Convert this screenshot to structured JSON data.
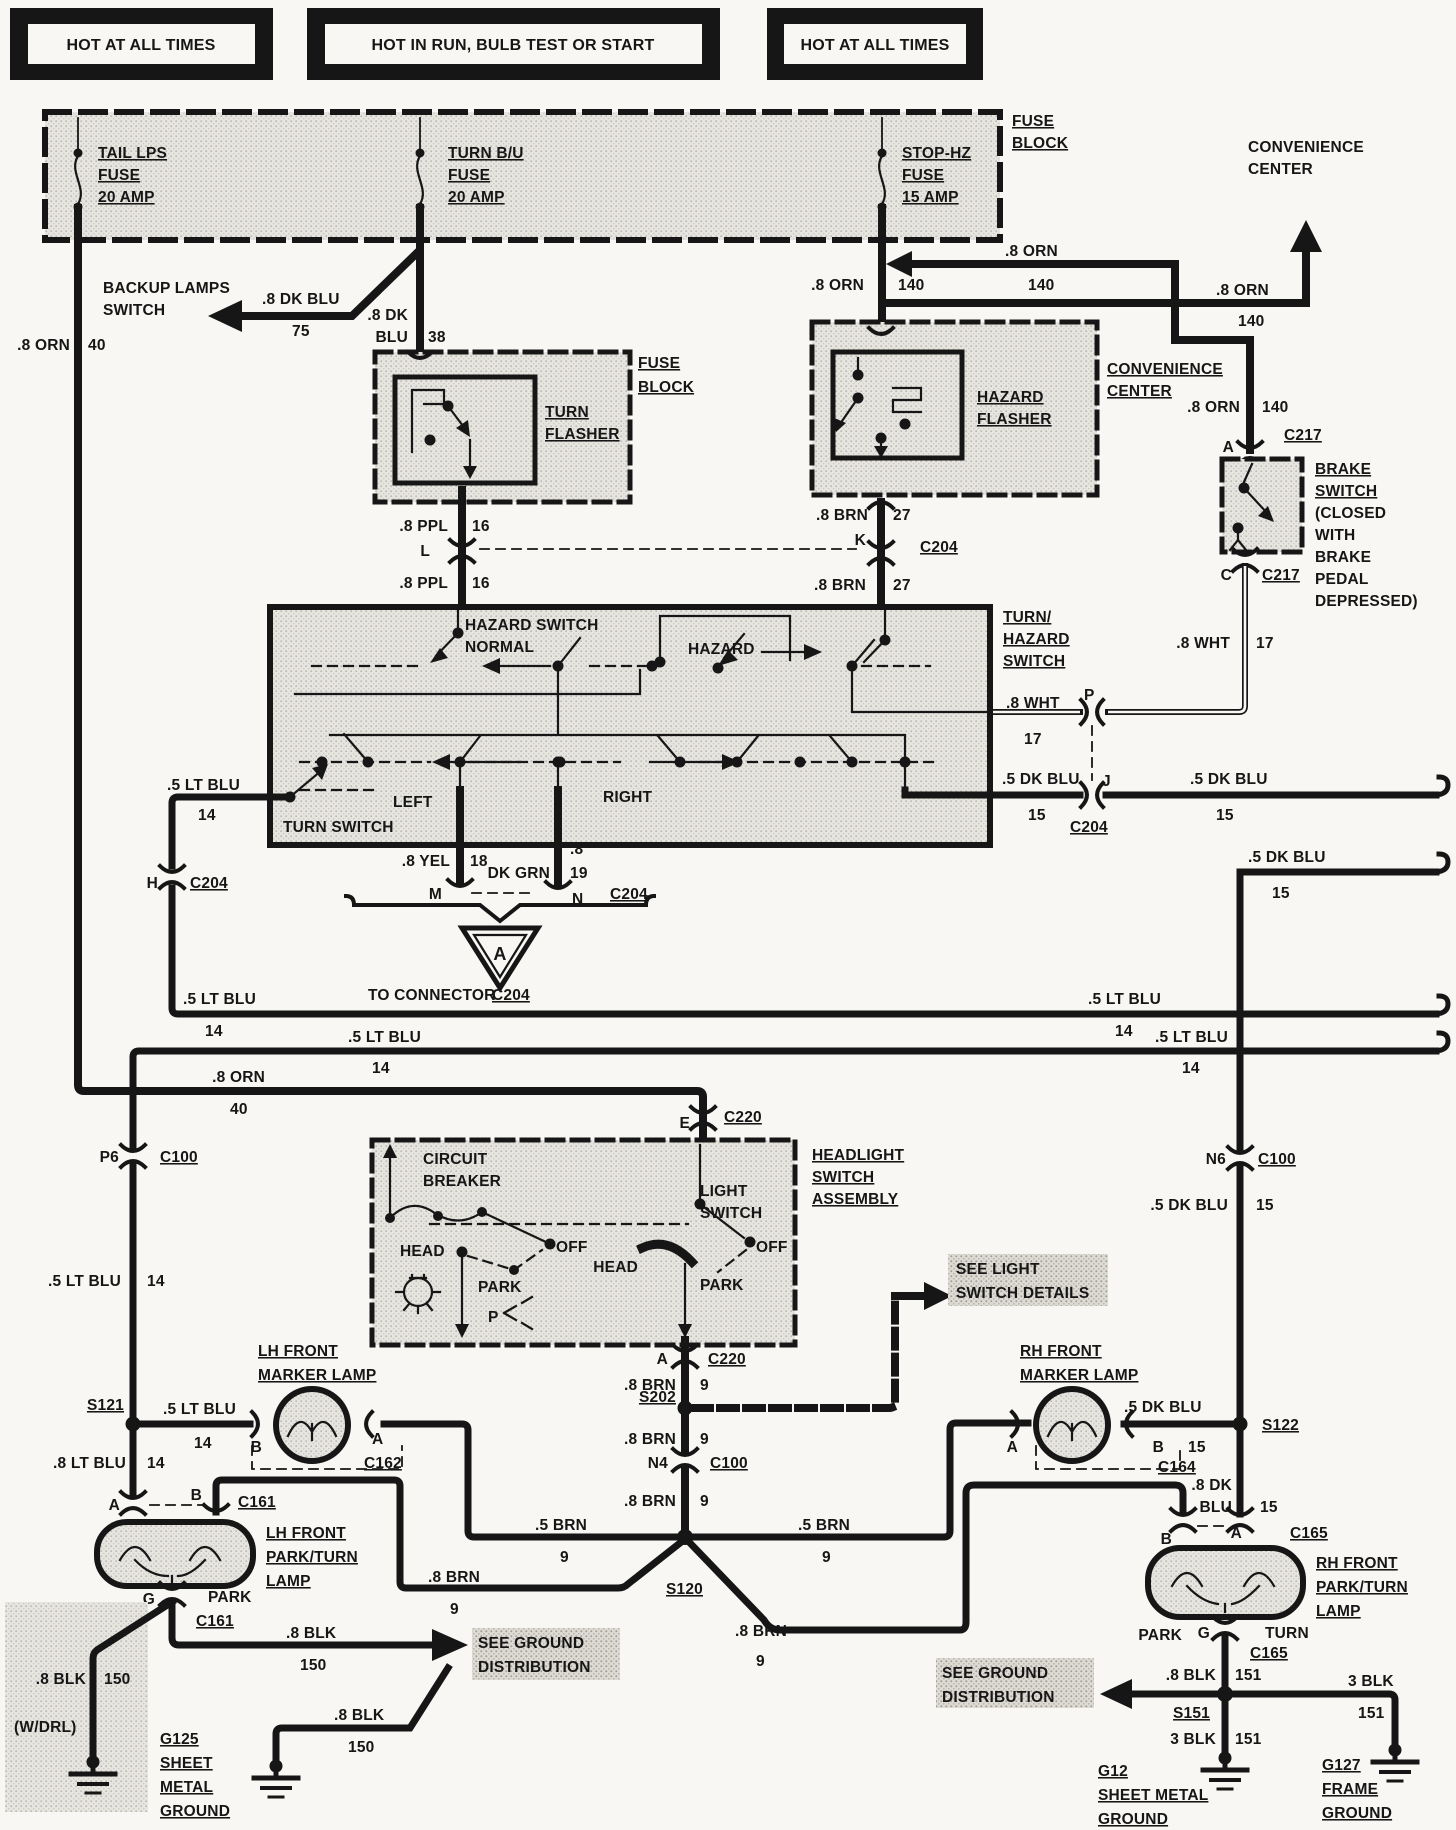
{
  "colors": {
    "ink": "#161616",
    "paper": "#f8f7f4",
    "shade": "#e7e5e0",
    "shade_dark": "#dedbd4"
  },
  "headers": {
    "h1": "HOT AT ALL TIMES",
    "h2": "HOT IN RUN, BULB TEST OR START",
    "h3": "HOT AT ALL TIMES"
  },
  "fuse_block": {
    "title": [
      "FUSE",
      "BLOCK"
    ],
    "tail": [
      "TAIL LPS",
      "FUSE",
      "20 AMP"
    ],
    "turn": [
      "TURN B/U",
      "FUSE",
      "20 AMP"
    ],
    "stop": [
      "STOP-HZ",
      "FUSE",
      "15 AMP"
    ]
  },
  "wires": {
    "orn": ".8 ORN",
    "n140": "140",
    "n40": "40",
    "dkblu8": ".8 DK BLU",
    "n75": "75",
    "dk8": ".8 DK",
    "blu": "BLU",
    "n38": "38",
    "ppl": ".8 PPL",
    "n16": "16",
    "brn8": ".8 BRN",
    "n27": "27",
    "n9": "9",
    "brn5": ".5 BRN",
    "wht": ".8 WHT",
    "n17": "17",
    "dkblu5": ".5 DK BLU",
    "n15": "15",
    "ltblu5": ".5 LT BLU",
    "ltblu8": ".8 LT BLU",
    "n14": "14",
    "yel": ".8 YEL",
    "n18": "18",
    "dot8": ".8",
    "dkgrn": "DK GRN",
    "n19": "19",
    "blk8": ".8 BLK",
    "n150": "150",
    "n151": "151",
    "blk3": "3 BLK"
  },
  "components": {
    "backup": [
      "BACKUP LAMPS",
      "SWITCH"
    ],
    "fuse_block2": [
      "FUSE",
      "BLOCK"
    ],
    "turn_flasher": [
      "TURN",
      "FLASHER"
    ],
    "hazard_flasher": [
      "HAZARD",
      "FLASHER"
    ],
    "convenience": [
      "CONVENIENCE",
      "CENTER"
    ],
    "brake_switch": [
      "BRAKE",
      "SWITCH",
      "(CLOSED",
      "WITH",
      "BRAKE",
      "PEDAL",
      "DEPRESSED)"
    ],
    "turn_hazard": [
      "TURN/",
      "HAZARD",
      "SWITCH"
    ],
    "hazard_normal": [
      "HAZARD SWITCH",
      "NORMAL"
    ],
    "hazard_pos": "HAZARD",
    "left": "LEFT",
    "right": "RIGHT",
    "turn_switch": "TURN SWITCH",
    "to_connector": "TO CONNECTOR",
    "tri_a": "A",
    "hsa": [
      "HEADLIGHT",
      "SWITCH",
      "ASSEMBLY"
    ],
    "circuit_breaker": [
      "CIRCUIT",
      "BREAKER"
    ],
    "light_switch": [
      "LIGHT",
      "SWITCH"
    ],
    "head": "HEAD",
    "off": "OFF",
    "park": "PARK",
    "p_pos": "P",
    "see_light": [
      "SEE LIGHT",
      "SWITCH DETAILS"
    ],
    "see_ground": [
      "SEE GROUND",
      "DISTRIBUTION"
    ],
    "lh_marker": [
      "LH FRONT",
      "MARKER LAMP"
    ],
    "rh_marker": [
      "RH FRONT",
      "MARKER LAMP"
    ],
    "lh_pt": [
      "LH FRONT",
      "PARK/TURN",
      "LAMP"
    ],
    "rh_pt": [
      "RH FRONT",
      "PARK/TURN",
      "LAMP"
    ],
    "turn_cav": "TURN",
    "wdrl": "(W/DRL)"
  },
  "connectors": {
    "c204": "C204",
    "c217": "C217",
    "c100": "C100",
    "c220": "C220",
    "c161": "C161",
    "c162": "C162",
    "c164": "C164",
    "c165": "C165"
  },
  "cavities": {
    "A": "A",
    "B": "B",
    "C": "C",
    "E": "E",
    "G": "G",
    "H": "H",
    "J": "J",
    "K": "K",
    "L": "L",
    "M": "M",
    "N": "N",
    "P": "P",
    "p6": "P6",
    "n4": "N4",
    "n6": "N6"
  },
  "splices": {
    "s120": "S120",
    "s121": "S121",
    "s122": "S122",
    "s151": "S151",
    "s202": "S202"
  },
  "grounds": {
    "g125": [
      "G125",
      "SHEET",
      "METAL",
      "GROUND"
    ],
    "g12": [
      "G12",
      "SHEET METAL",
      "GROUND"
    ],
    "g127": [
      "G127",
      "FRAME",
      "GROUND"
    ]
  }
}
